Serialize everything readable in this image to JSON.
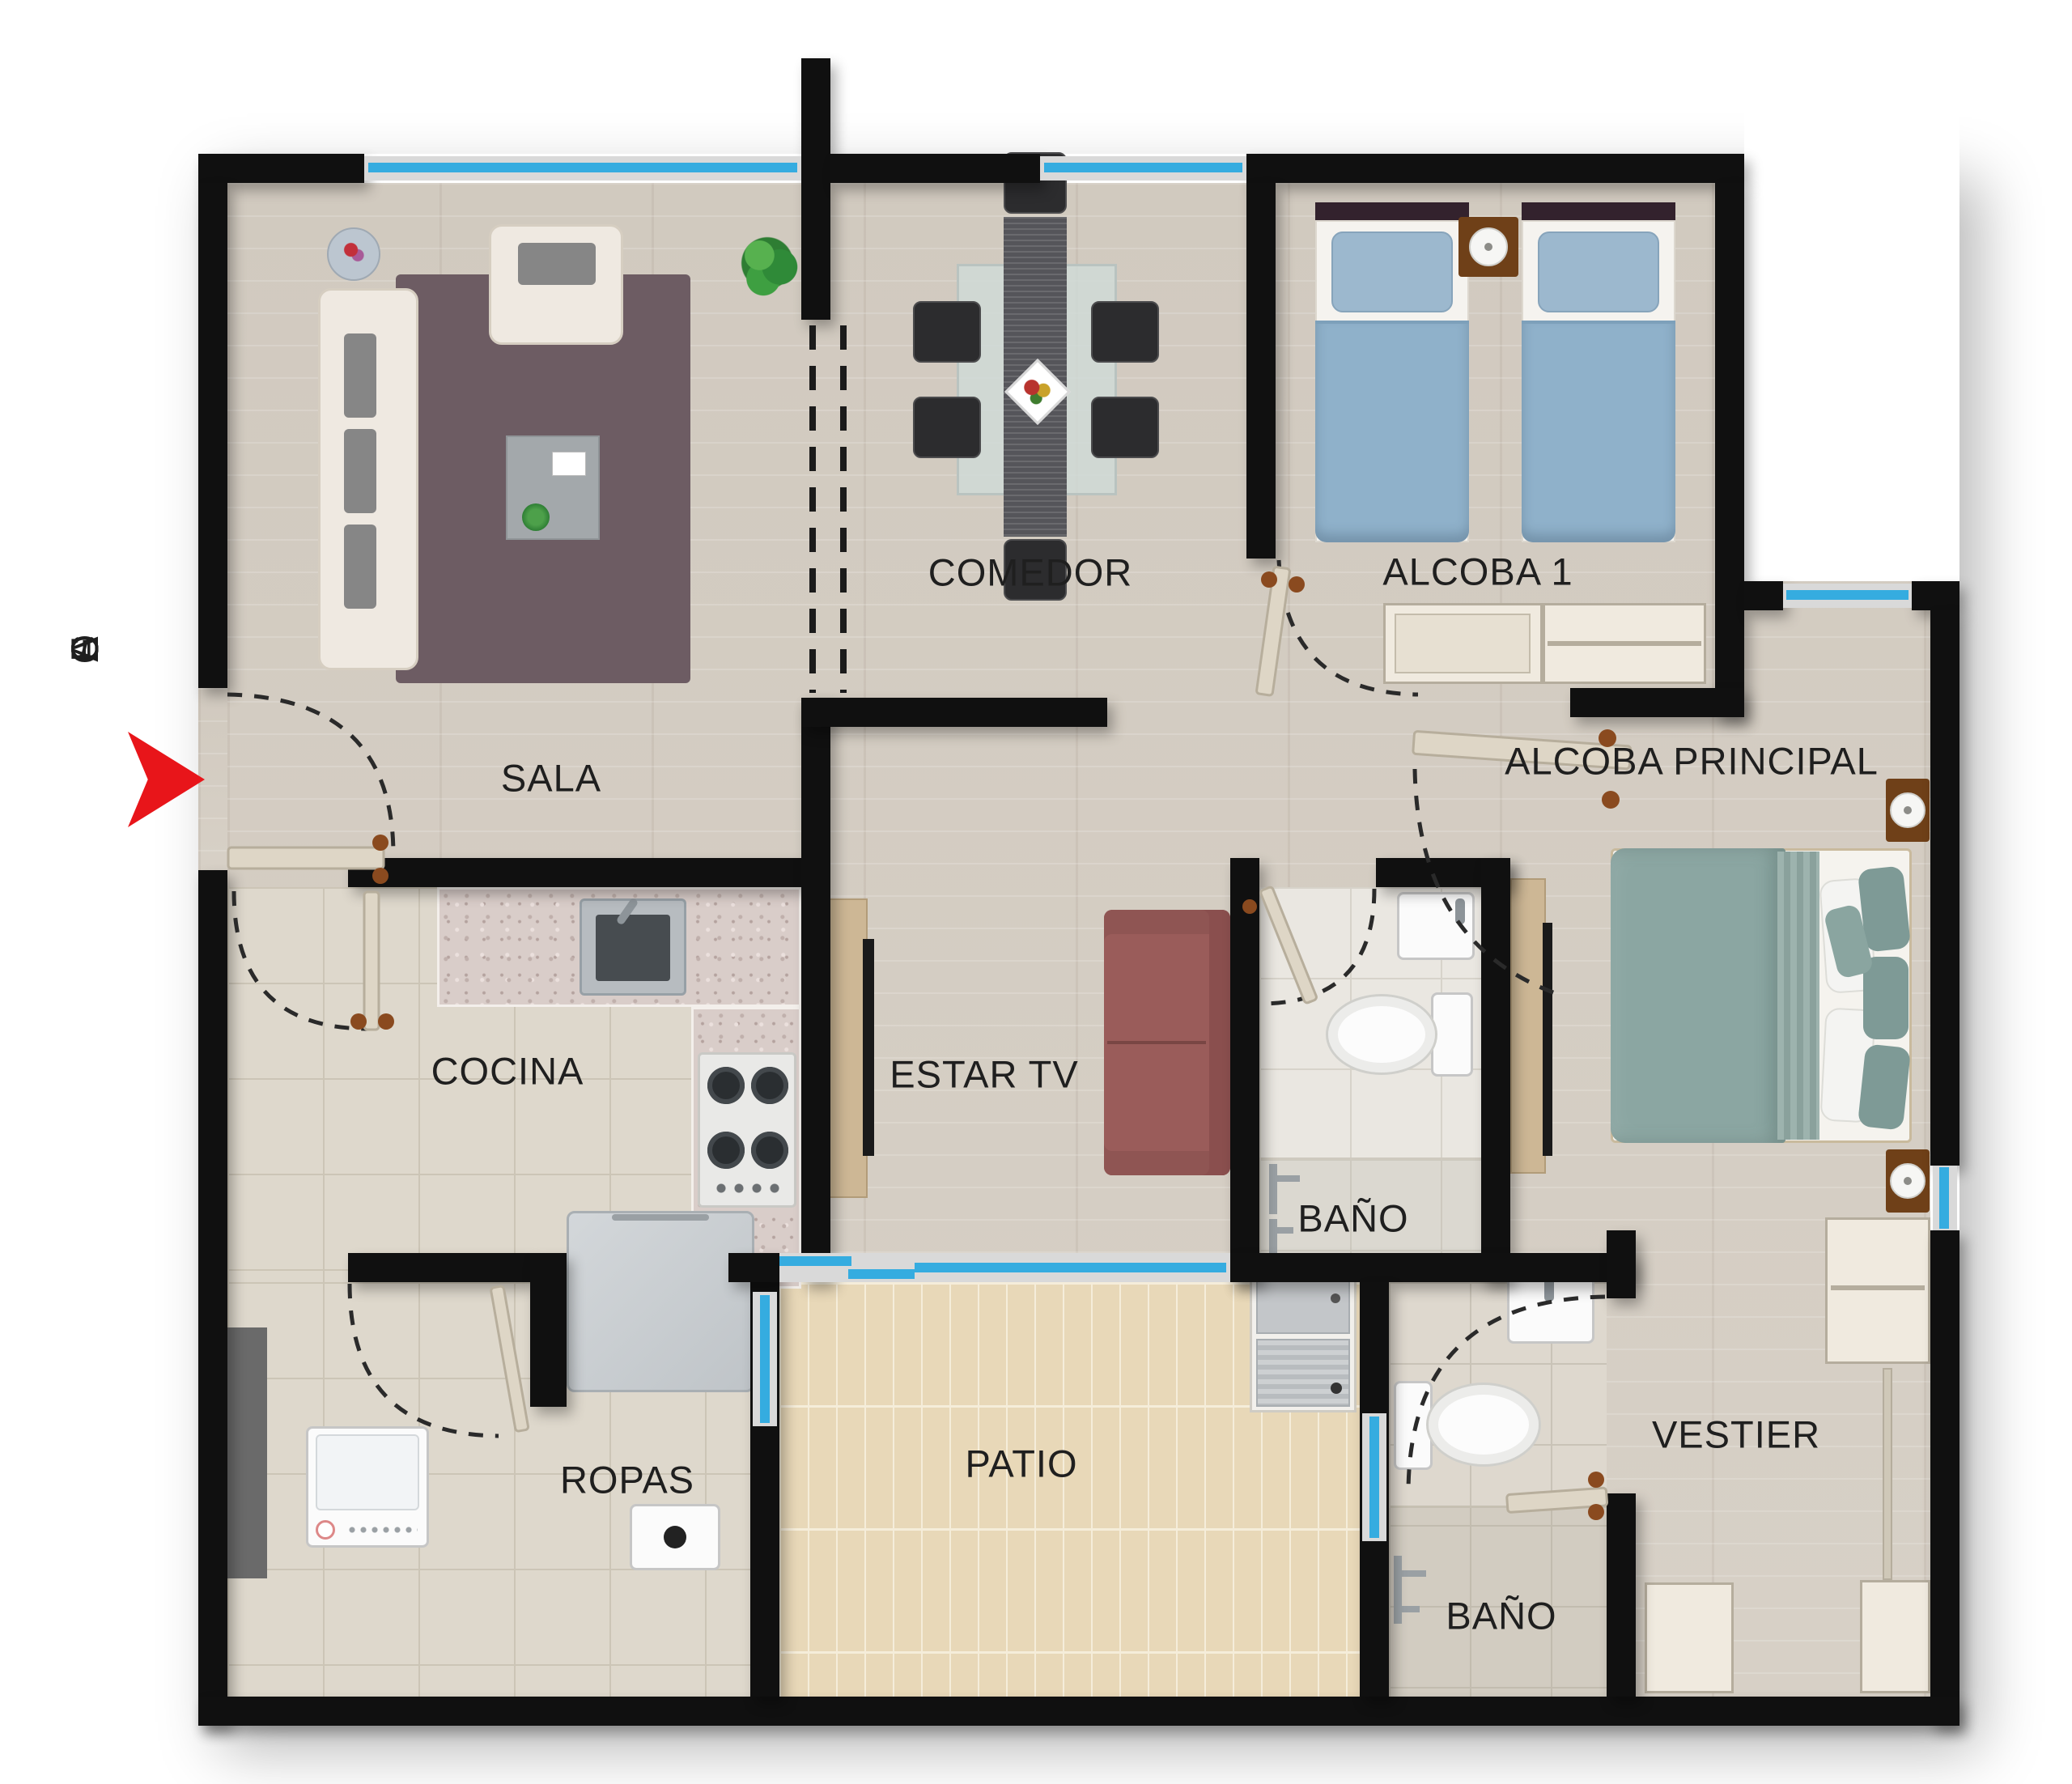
{
  "rooms": [
    {
      "id": "sala",
      "label": "SALA"
    },
    {
      "id": "comedor",
      "label": "COMEDOR"
    },
    {
      "id": "alcoba-1",
      "label": "ALCOBA 1"
    },
    {
      "id": "alcoba-principal",
      "label": "ALCOBA PRINCIPAL"
    },
    {
      "id": "cocina",
      "label": "COCINA"
    },
    {
      "id": "estar-tv",
      "label": "ESTAR TV"
    },
    {
      "id": "bano-principal",
      "label": "BAÑO"
    },
    {
      "id": "ropas",
      "label": "ROPAS"
    },
    {
      "id": "patio",
      "label": "PATIO"
    },
    {
      "id": "vestier",
      "label": "VESTIER"
    },
    {
      "id": "bano-social",
      "label": "BAÑO"
    }
  ],
  "entry": {
    "label": "ACCESO"
  },
  "colors": {
    "wall": "#101010",
    "window": "#35ace0",
    "window-frame": "#d9d9d9",
    "accent": "#e8151a",
    "wood": "#d6cfc5",
    "tile-kitchen": "#ded8cc",
    "tile-patio": "#e8d8b8",
    "tile-bath": "#eae7e1",
    "tile-bath2": "#ded8ce",
    "rug": "#6d5c63",
    "sofa-estar": "#9a5c5a",
    "bed-twin": "#8fb1ca",
    "bed-principal": "#8ba6a2",
    "furniture-wood": "#cdb795",
    "nightstand": "#6f4018",
    "label": "#1f1f1f"
  }
}
